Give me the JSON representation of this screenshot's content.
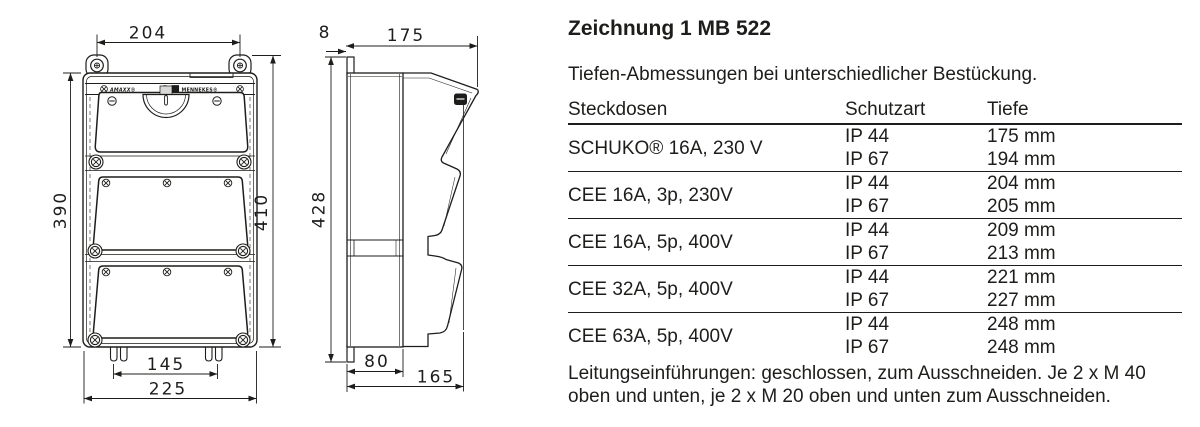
{
  "drawing": {
    "front_view": {
      "brand_left": "AMAXX®",
      "brand_right": "MENNEKES®",
      "dims": {
        "top_width": "204",
        "height_left": "390",
        "height_right": "410",
        "bottom_inner": "145",
        "bottom_outer": "225"
      }
    },
    "side_view": {
      "dims": {
        "flange_thickness": "8",
        "top_depth": "175",
        "height": "428",
        "body_depth": "80",
        "total_depth": "165"
      }
    }
  },
  "content": {
    "title": "Zeichnung 1 MB 522",
    "intro": "Tiefen-Abmessungen bei unterschiedlicher Bestückung.",
    "table": {
      "col_steckdosen": "Steckdosen",
      "col_schutzart": "Schutzart",
      "col_tiefe": "Tiefe",
      "groups": [
        {
          "steckdose": "SCHUKO® 16A, 230 V",
          "rows": [
            {
              "schutzart": "IP 44",
              "tiefe": "175 mm"
            },
            {
              "schutzart": "IP 67",
              "tiefe": "194 mm"
            }
          ]
        },
        {
          "steckdose": "CEE 16A, 3p, 230V",
          "rows": [
            {
              "schutzart": "IP 44",
              "tiefe": "204 mm"
            },
            {
              "schutzart": "IP 67",
              "tiefe": "205 mm"
            }
          ]
        },
        {
          "steckdose": "CEE 16A, 5p, 400V",
          "rows": [
            {
              "schutzart": "IP 44",
              "tiefe": "209 mm"
            },
            {
              "schutzart": "IP 67",
              "tiefe": "213 mm"
            }
          ]
        },
        {
          "steckdose": "CEE 32A, 5p, 400V",
          "rows": [
            {
              "schutzart": "IP 44",
              "tiefe": "221 mm"
            },
            {
              "schutzart": "IP 67",
              "tiefe": "227 mm"
            }
          ]
        },
        {
          "steckdose": "CEE 63A, 5p, 400V",
          "rows": [
            {
              "schutzart": "IP 44",
              "tiefe": "248 mm"
            },
            {
              "schutzart": "IP 67",
              "tiefe": "248 mm"
            }
          ]
        }
      ]
    },
    "footer_line1": "Leitungseinführungen: geschlossen, zum Ausschneiden. Je 2 x M 40",
    "footer_line2": "oben und unten, je 2 x M 20 oben und unten zum Ausschneiden."
  },
  "colors": {
    "ink": "#1d1d1b",
    "bg": "#ffffff"
  }
}
